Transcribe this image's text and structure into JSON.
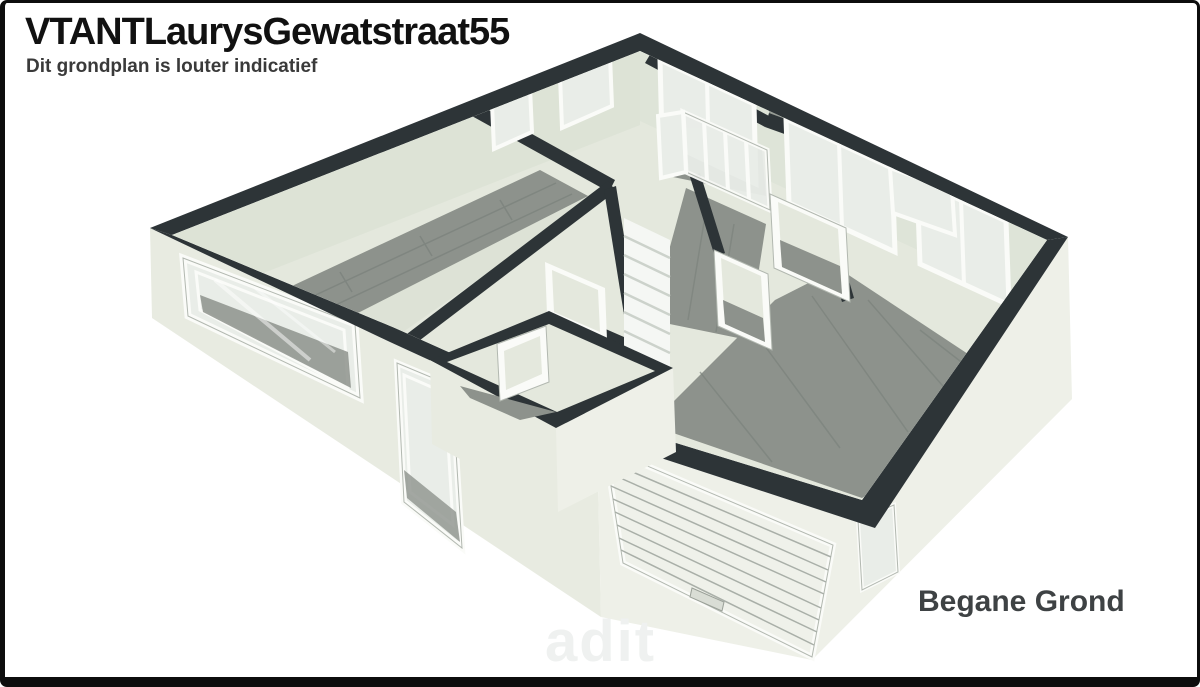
{
  "header": {
    "title": "VTANTLaurysGewatstraat55",
    "subtitle": "Dit grondplan is louter indicatief"
  },
  "floor_label": "Begane Grond",
  "watermark": "adit",
  "colors": {
    "page_bg": "#ffffff",
    "border": "#0d0d0d",
    "text": "#111111",
    "subtext": "#3a3a3a",
    "label": "#3e4244",
    "watermark": "#eff1f0",
    "wall_top": "#2d3437",
    "face_sw": "#e8ebe1",
    "face_se": "#eef0e8",
    "interior": "#e4e8dd",
    "wall_int": "#dbe1d5",
    "wood": "#8d928c",
    "wood_dark": "#7a817b",
    "glass": "#e9ede8",
    "frame": "#fafbf8",
    "frame_edge": "#b2b8b0",
    "stair": "#f5f7f4",
    "stair_line": "#ccd2cb"
  },
  "floorplan": {
    "view": "3d-axonometric-floorplan",
    "features": [
      "living-room",
      "entry-hall",
      "glass-sliding-doors",
      "staircase",
      "hallway",
      "back-rooms",
      "garage-room",
      "porch-vestibule",
      "garage-door",
      "front-windows",
      "back-windows",
      "interior-doors",
      "wood-flooring"
    ]
  }
}
